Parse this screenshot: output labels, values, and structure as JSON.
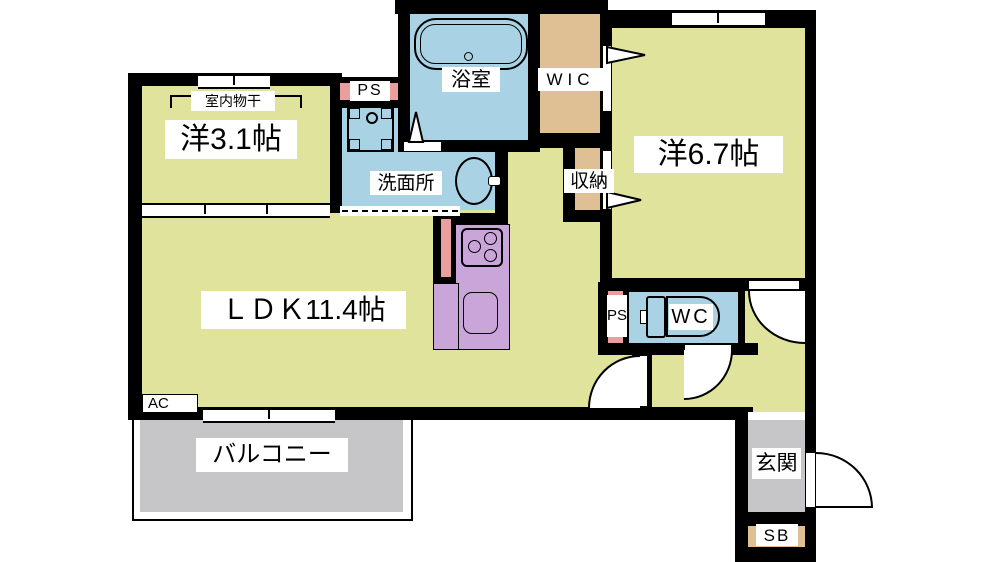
{
  "title": "apartment-floor-plan",
  "rooms": {
    "bedroom_small": {
      "label": "洋3.1帖",
      "laundry_label": "室内物干"
    },
    "ldk": {
      "label": "ＬＤＫ11.4帖",
      "ac_label": "AC"
    },
    "bedroom_large": {
      "label": "洋6.7帖"
    },
    "bath": {
      "label": "浴室"
    },
    "washroom": {
      "label": "洗面所"
    },
    "wic": {
      "label": "WIC"
    },
    "closet": {
      "label": "収納"
    },
    "toilet": {
      "label": "WC"
    },
    "pipe_space_top": {
      "label": "PS"
    },
    "pipe_space_wc": {
      "label": "PS"
    },
    "balcony": {
      "label": "バルコニー"
    },
    "entrance": {
      "label": "玄関"
    },
    "shoe_box": {
      "label": "SB"
    }
  },
  "colors": {
    "floor": "#dfe39b",
    "water": "#a9d3e5",
    "storage": "#dfc095",
    "kitchen": "#c9a5da",
    "ps": "#e89f9e",
    "outdoor": "#c6c6c8",
    "wall": "#000000"
  }
}
